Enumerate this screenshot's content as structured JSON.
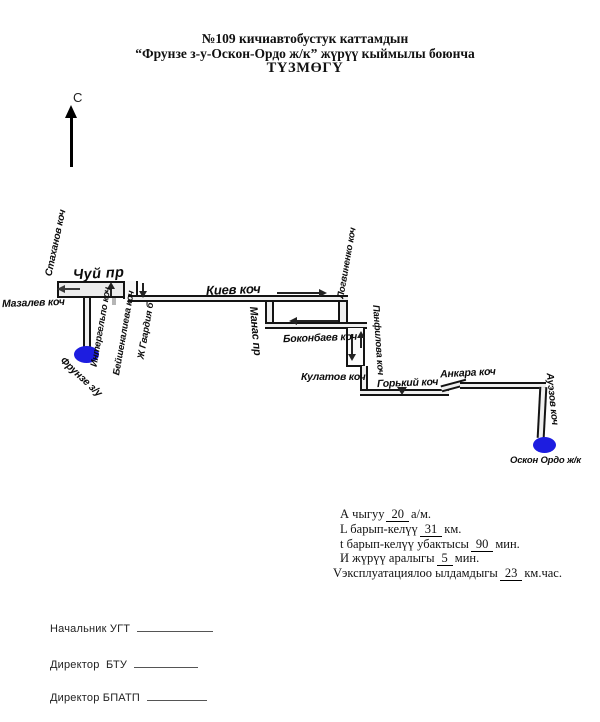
{
  "title": {
    "line1": "№109 кичиавтобустук каттамдын",
    "line2": "“Фрунзе з-у-Оскон-Ордо ж/к” жүрүү кыймылы боюнча",
    "line3": "ТҮЗМӨГҮ"
  },
  "compass": {
    "label": "С"
  },
  "map": {
    "streets": {
      "stakhanov": "Стаханов коч",
      "mazalev": "Мазалев коч",
      "chui": "Чуй пр",
      "intergelpo": "Интергельпо коч",
      "beishenalieva": "Бейшеналиева коч",
      "gvardia": "Ж Гвардия б",
      "kiev": "Киев коч",
      "logvinenko": "Логвиненко коч",
      "manas": "Манас пр",
      "bokonbaev": "Боконбаев коч",
      "panfilova": "Панфилова коч",
      "kulatov": "Кулатов коч",
      "gorky": "Горький коч",
      "ankara": "Анкара коч",
      "auezov": "Ауэзов коч"
    },
    "terminals": {
      "frunze": "Фрунзе з/у",
      "oskon_ordo": "Оскон Ордо ж/к"
    }
  },
  "stats": {
    "rows": [
      {
        "pre": "А чыгуу",
        "value": "20",
        "post": "а/м."
      },
      {
        "pre": "L барып-келүү",
        "value": "31",
        "post": "км."
      },
      {
        "pre": "t барып-келүү убактысы",
        "value": "90",
        "post": "мин."
      },
      {
        "pre": "И жүрүү аралыгы",
        "value": "5",
        "post": "мин."
      },
      {
        "pre": "Vэксплуатациялоо ылдамдыгы",
        "value": "23",
        "post": "км.час."
      }
    ]
  },
  "signatures": [
    {
      "label": "Начальник УГТ"
    },
    {
      "label": "Директор  БТУ"
    },
    {
      "label": "Директор БПАТП"
    }
  ],
  "colors": {
    "terminal_blue": "#1d1de0",
    "road_line": "#141414",
    "arrow": "#333333"
  }
}
